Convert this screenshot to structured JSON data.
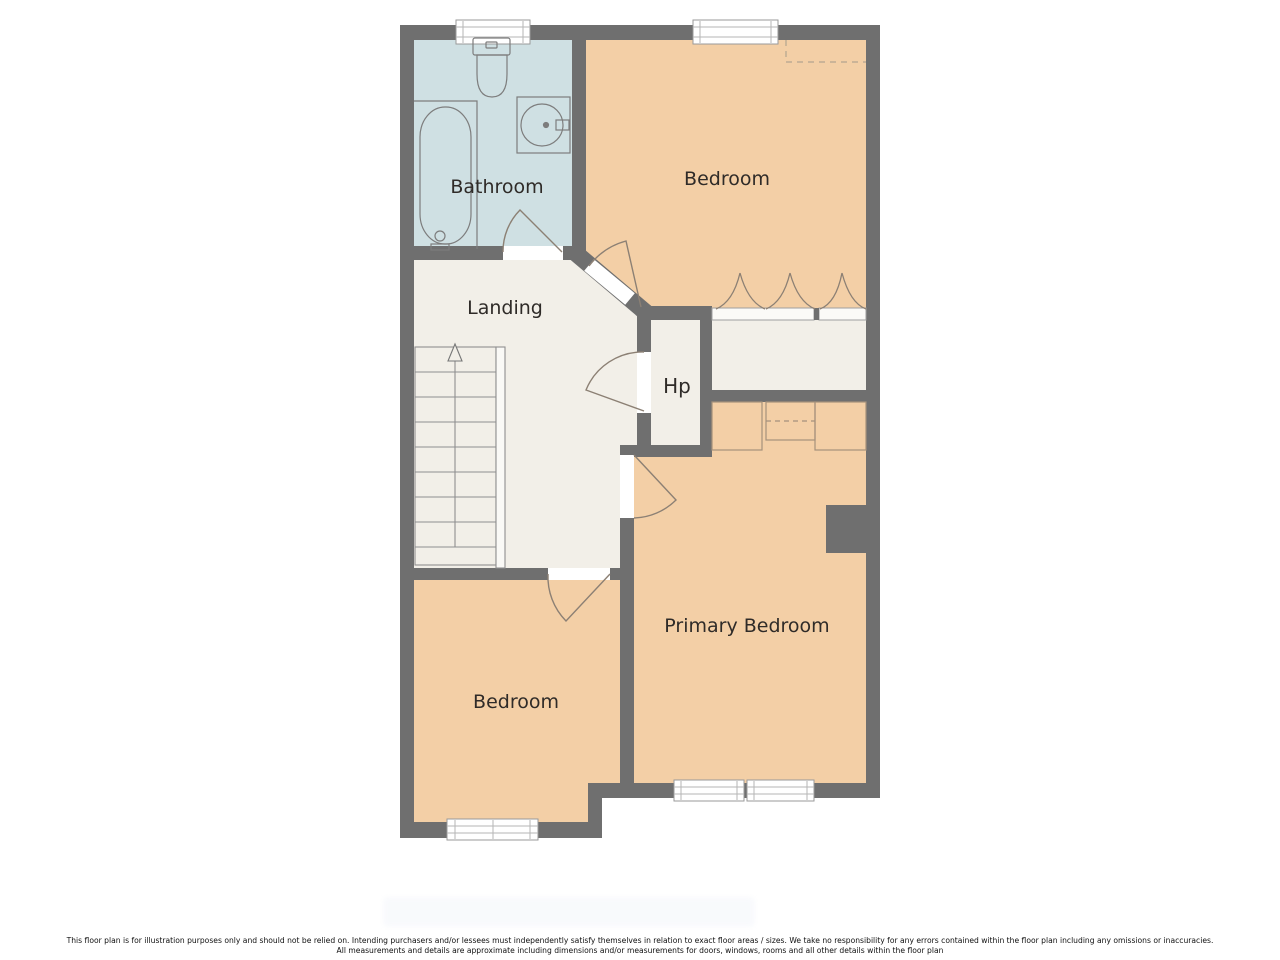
{
  "floorplan": {
    "rooms": {
      "bathroom": "Bathroom",
      "bedroom_top": "Bedroom",
      "landing": "Landing",
      "hot_press": "Hp",
      "primary_bedroom": "Primary Bedroom",
      "bedroom_bottom": "Bedroom"
    },
    "colors": {
      "wall": "#6f6f6f",
      "bedroom_fill": "#f3cfa6",
      "bathroom_fill": "#cfe0e3",
      "circulation_fill": "#f2efe8",
      "window_fill": "#ffffff",
      "door_arc": "#8c8074",
      "label_text": "#2f2b28"
    }
  },
  "disclaimer": {
    "line1": "This floor plan is for illustration purposes only and should not be relied on. Intending purchasers and/or lessees must independently satisfy themselves in relation to exact floor areas / sizes. We take no responsibility for any errors contained within the floor plan including any omissions or inaccuracies.",
    "line2": "All measurements and details are approximate including dimensions and/or measurements for doors, windows, rooms and all other details within the floor plan"
  }
}
